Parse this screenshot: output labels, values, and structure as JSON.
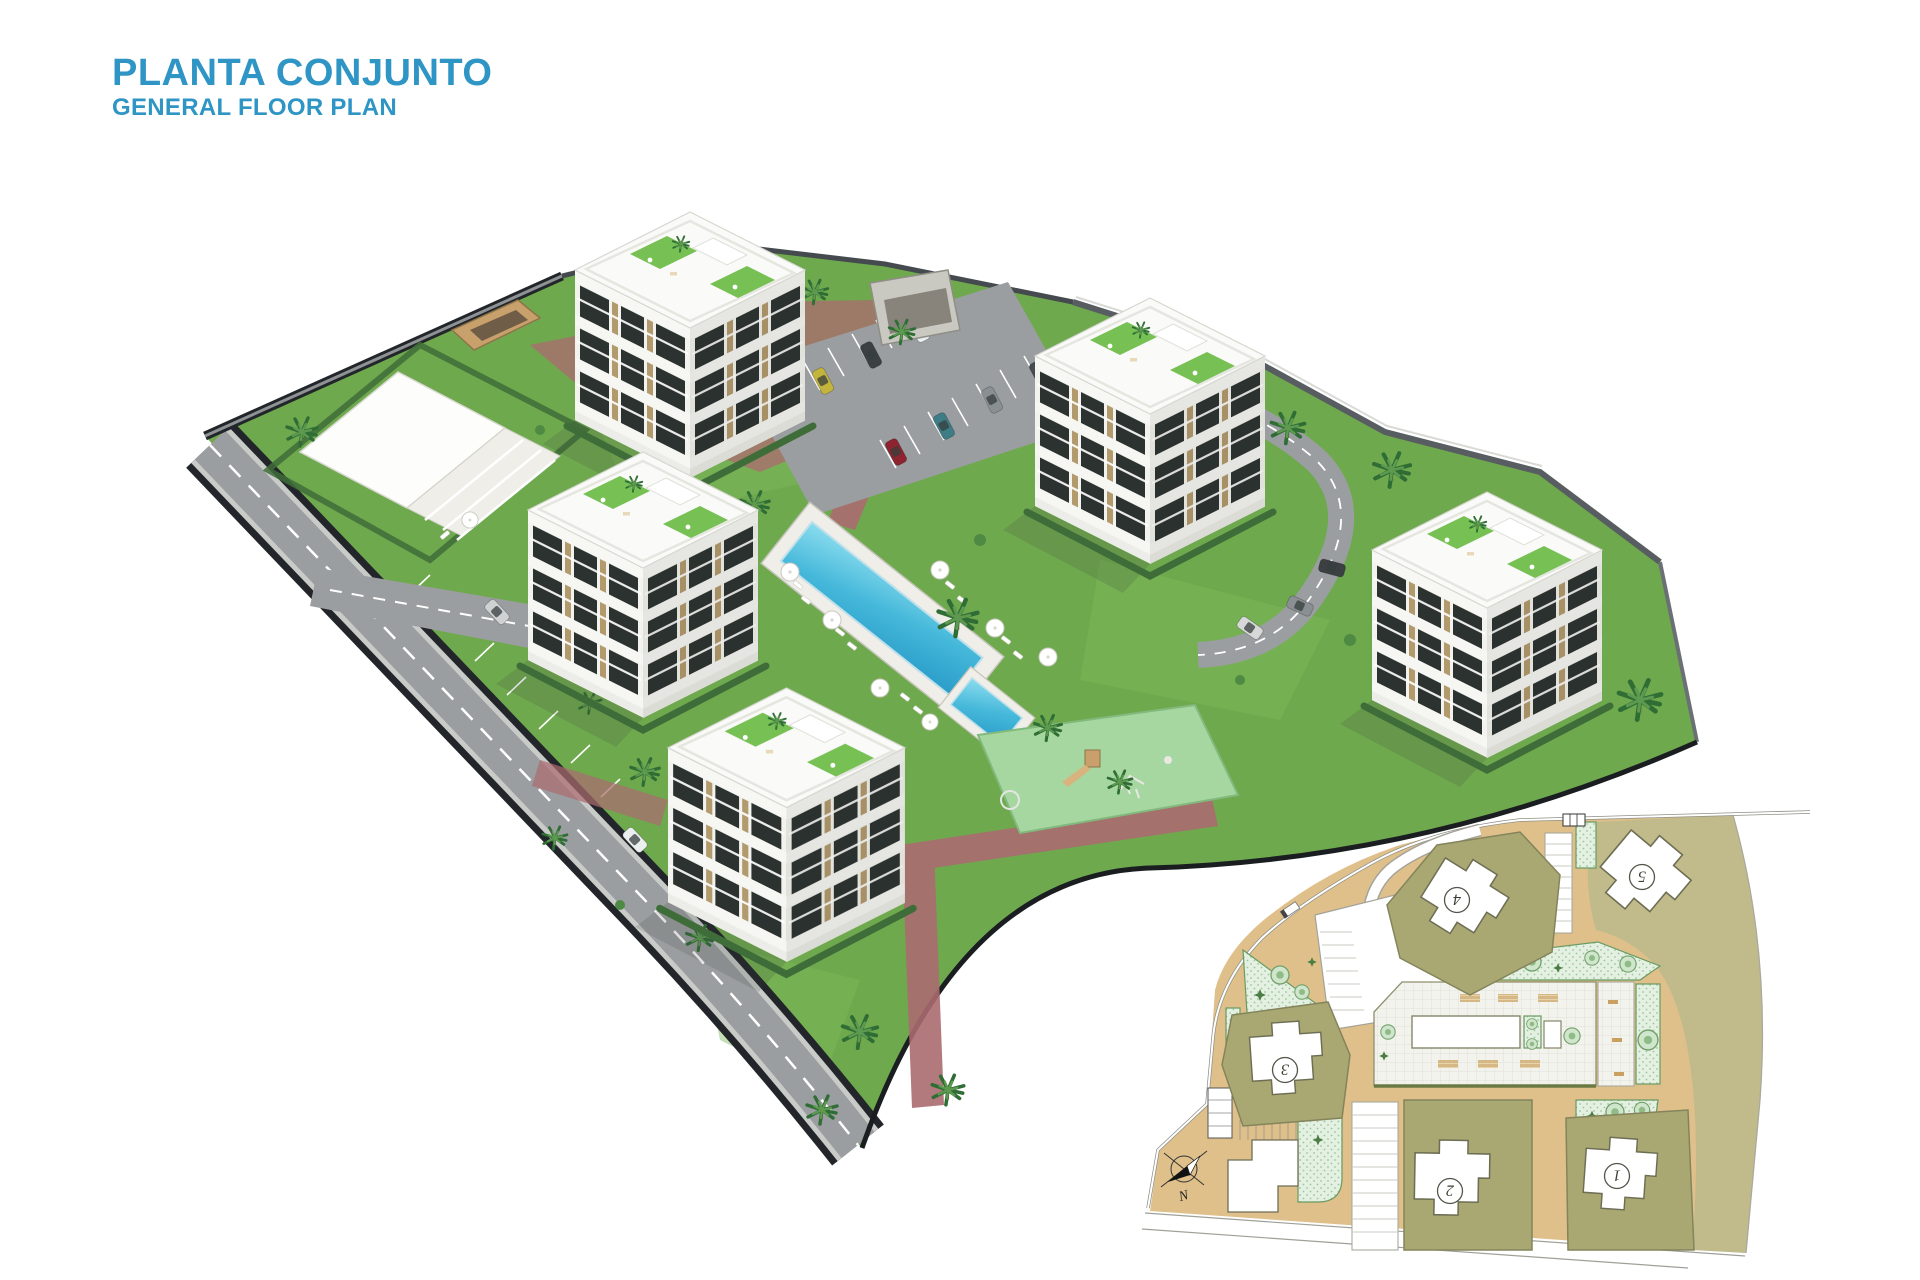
{
  "header": {
    "title": "PLANTA CONJUNTO",
    "subtitle": "GENERAL FLOOR PLAN"
  },
  "colors": {
    "title_blue": "#2e95c5",
    "lawn": "#6fa94e",
    "lawn_light": "#7db85a",
    "asphalt": "#9b9ea0",
    "wall_dark": "#22262a",
    "brick_path": "#ab6b70",
    "pool_light": "#7fd4e8",
    "pool_deep": "#2a9cc9",
    "building_face": "#f1f1ee",
    "building_side": "#e2e2dd",
    "roof_white": "#fafaf8",
    "turf": "#76c054",
    "hedge": "#3f6d39",
    "plan_sand": "#dfc08a",
    "plan_olive": "#a9a873",
    "plan_khaki": "#c1bb8c",
    "plan_garden_fill": "#e3f0e2",
    "plan_garden_line": "#699a62"
  },
  "inset_plan": {
    "buildings": [
      {
        "label": "1"
      },
      {
        "label": "2"
      },
      {
        "label": "3"
      },
      {
        "label": "4"
      },
      {
        "label": "5"
      }
    ],
    "compass_label": "N"
  }
}
